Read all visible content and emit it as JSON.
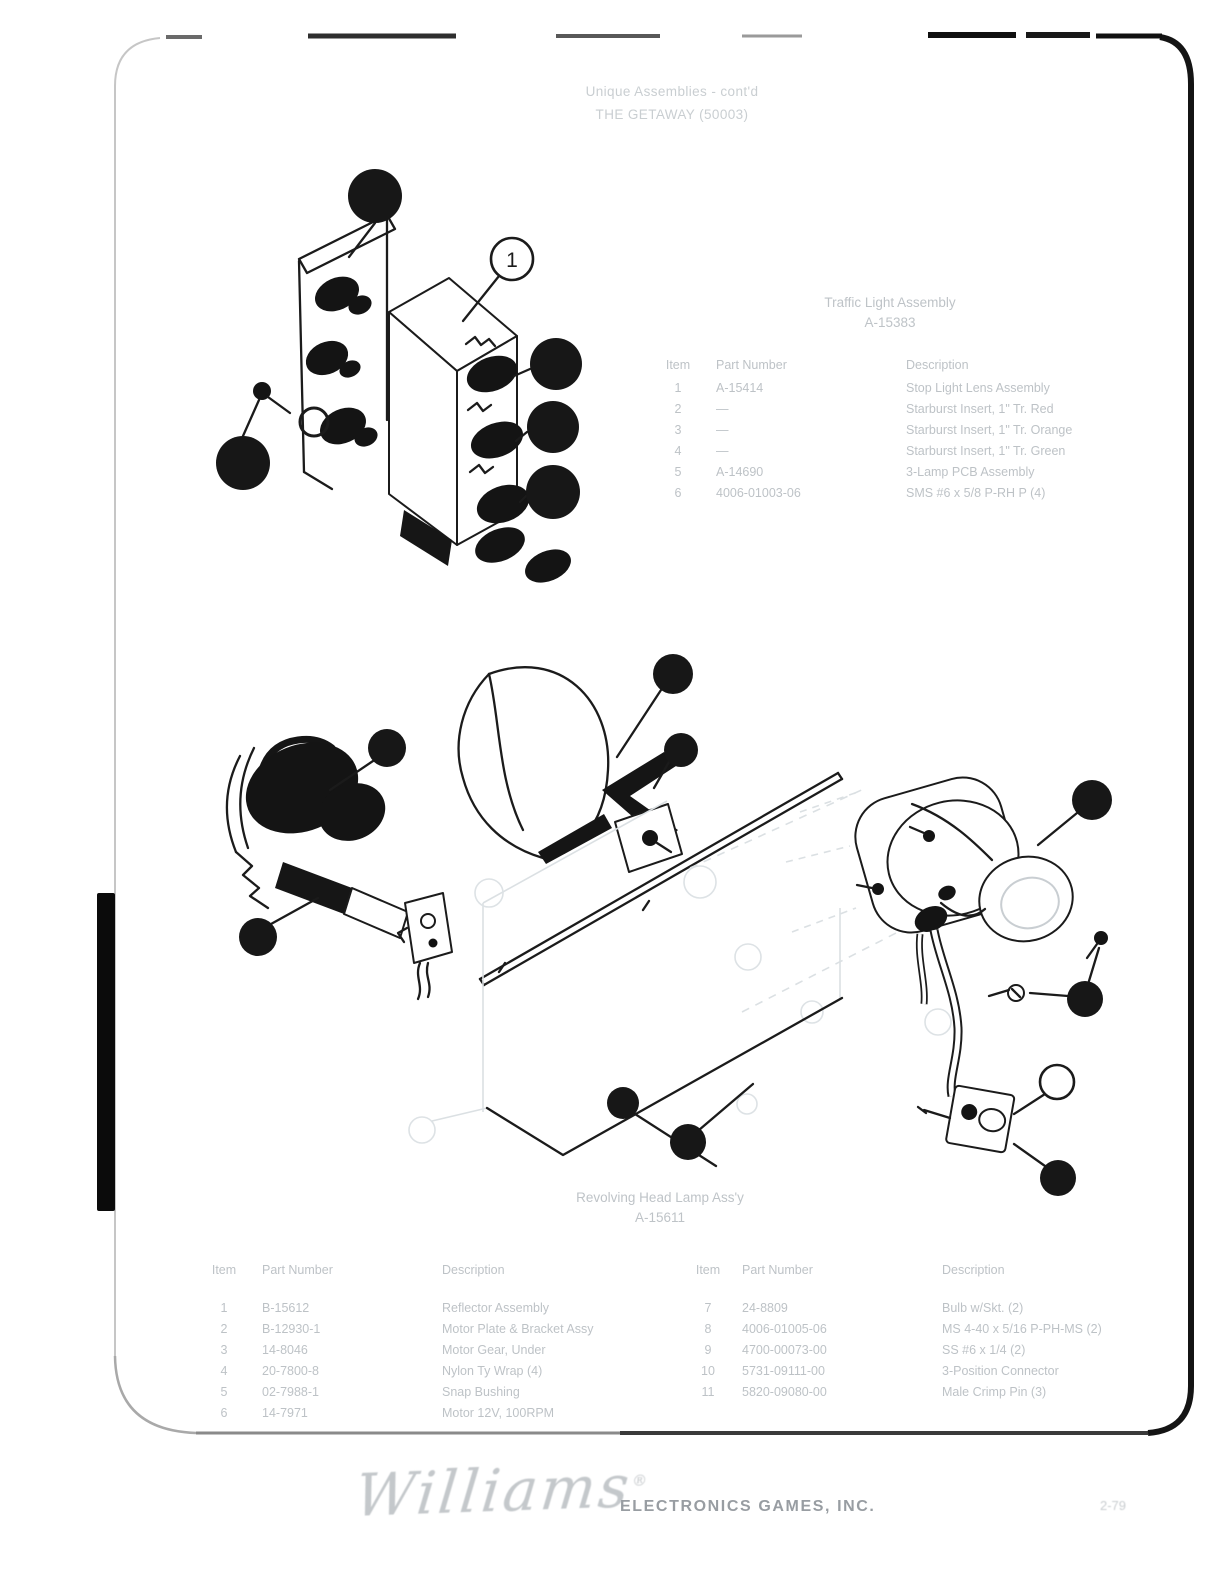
{
  "header": {
    "line1": "Unique Assemblies - cont'd",
    "line2": "THE GETAWAY (50003)"
  },
  "traffic_light": {
    "title": "Traffic Light Assembly",
    "part_no": "A-15383",
    "callout": "1",
    "columns": [
      "Item",
      "Part Number",
      "Description"
    ],
    "rows": [
      [
        "1",
        "A-15414",
        "Stop Light Lens Assembly"
      ],
      [
        "2",
        "—",
        "Starburst Insert, 1\" Tr. Red"
      ],
      [
        "3",
        "—",
        "Starburst Insert, 1\" Tr. Orange"
      ],
      [
        "4",
        "—",
        "Starburst Insert, 1\" Tr. Green"
      ],
      [
        "5",
        "A-14690",
        "3-Lamp PCB Assembly"
      ],
      [
        "6",
        "4006-01003-06",
        "SMS #6 x 5/8 P-RH P (4)"
      ]
    ]
  },
  "beacon": {
    "title": "Revolving Head Lamp Ass'y",
    "part_no": "A-15611",
    "columns": [
      "Item",
      "Part Number",
      "Description"
    ],
    "left_rows": [
      [
        "1",
        "B-15612",
        "Reflector Assembly"
      ],
      [
        "2",
        "B-12930-1",
        "Motor Plate & Bracket Assy"
      ],
      [
        "3",
        "14-8046",
        "Motor Gear, Under"
      ],
      [
        "4",
        "20-7800-8",
        "Nylon Ty Wrap (4)"
      ],
      [
        "5",
        "02-7988-1",
        "Snap Bushing"
      ],
      [
        "6",
        "14-7971",
        "Motor 12V, 100RPM"
      ]
    ],
    "right_rows": [
      [
        "7",
        "24-8809",
        "Bulb w/Skt. (2)"
      ],
      [
        "8",
        "4006-01005-06",
        "MS 4-40 x 5/16 P-PH-MS (2)"
      ],
      [
        "9",
        "4700-00073-00",
        "SS #6 x 1/4 (2)"
      ],
      [
        "10",
        "5731-09111-00",
        "3-Position Connector"
      ],
      [
        "11",
        "5820-09080-00",
        "Male Crimp Pin (3)"
      ]
    ]
  },
  "footer": {
    "logo": "Williams",
    "reg": "®",
    "company": "ELECTRONICS GAMES, INC.",
    "page_number": "2-79"
  },
  "colors": {
    "ink": "#1b1b1b",
    "faded_text": "#aeb4b9",
    "frame_dark": "#111111"
  }
}
